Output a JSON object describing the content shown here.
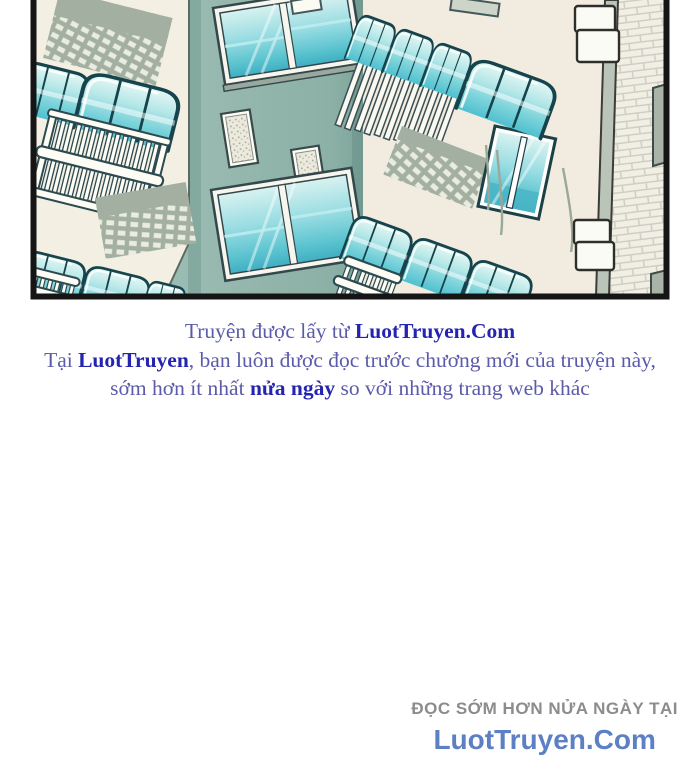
{
  "notice": {
    "line1": {
      "prefix": "Truyện được lấy từ ",
      "brand": "LuotTruyen.Com"
    },
    "line2": {
      "prefix": "Tại ",
      "brand": "LuotTruyen",
      "suffix": ", bạn luôn được đọc trước chương mới của truyện này,"
    },
    "line3": {
      "prefix": "sớm hơn ít nhất ",
      "highlight": "nửa ngày",
      "suffix": " so với những trang web khác"
    }
  },
  "footer": {
    "tagline": "ĐỌC SỚM HƠN NỬA NGÀY TẠI",
    "brand": "LuotTruyen.Com"
  },
  "colors": {
    "notice_text": "#5b5baa",
    "notice_brand": "#2424b0",
    "footer_tagline": "#8c8c8c",
    "footer_brand": "#5c80c3",
    "panel_border": "#151515",
    "wall_cream": "#f2eee1",
    "wall_green": "#8fb3a9",
    "awning_glass": "#7fd4dc",
    "brick_wall": "#f1eee3",
    "shadow_green_gray": "#a3b0a1"
  }
}
